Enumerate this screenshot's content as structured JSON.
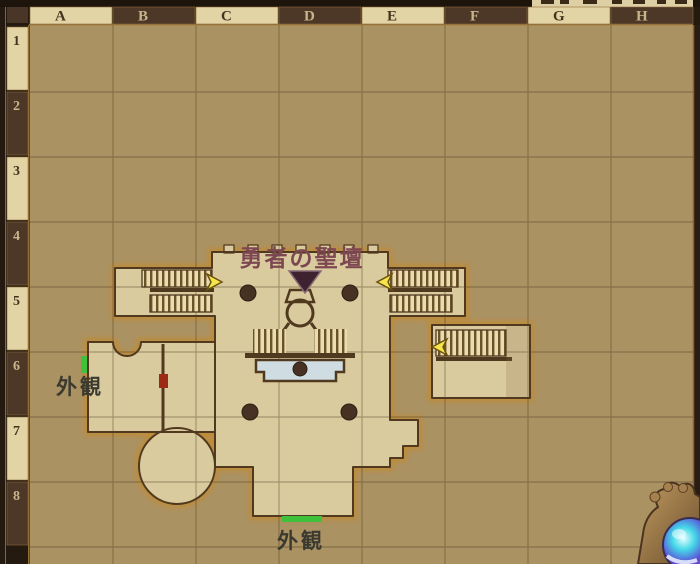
{
  "grid": {
    "columns": [
      "A",
      "B",
      "C",
      "D",
      "E",
      "F",
      "G",
      "H"
    ],
    "rows": [
      "1",
      "2",
      "3",
      "4",
      "5",
      "6",
      "7",
      "8"
    ]
  },
  "map": {
    "location_label": "勇者の聖壇",
    "west_exit_label": "外観",
    "south_exit_label": "外観"
  },
  "markers": {
    "warp_arrow_count": 3,
    "pillar_count": 4,
    "exit_marker_color": "#3fc13c",
    "door_marker_color": "#9b2914",
    "warp_arrow_color": "#f6e54a"
  },
  "colors": {
    "map_background": "#ab9263",
    "floor": "#dacb9f",
    "floor_glow": "#c28a2e",
    "wall_outline": "#50391f",
    "grid_line": "#6d5835",
    "header_light_bg": "#e3d4a6",
    "header_dark_bg": "#4d3827",
    "header_light_text": "#c8b58b",
    "header_dark_text": "#46331f",
    "location_label_color": "#7d4751",
    "exit_label_color": "#3b3a30",
    "altar_platform_blue": "#cfdde2",
    "frame_brown": "#241a10",
    "frame_gold": "#9a7437"
  }
}
